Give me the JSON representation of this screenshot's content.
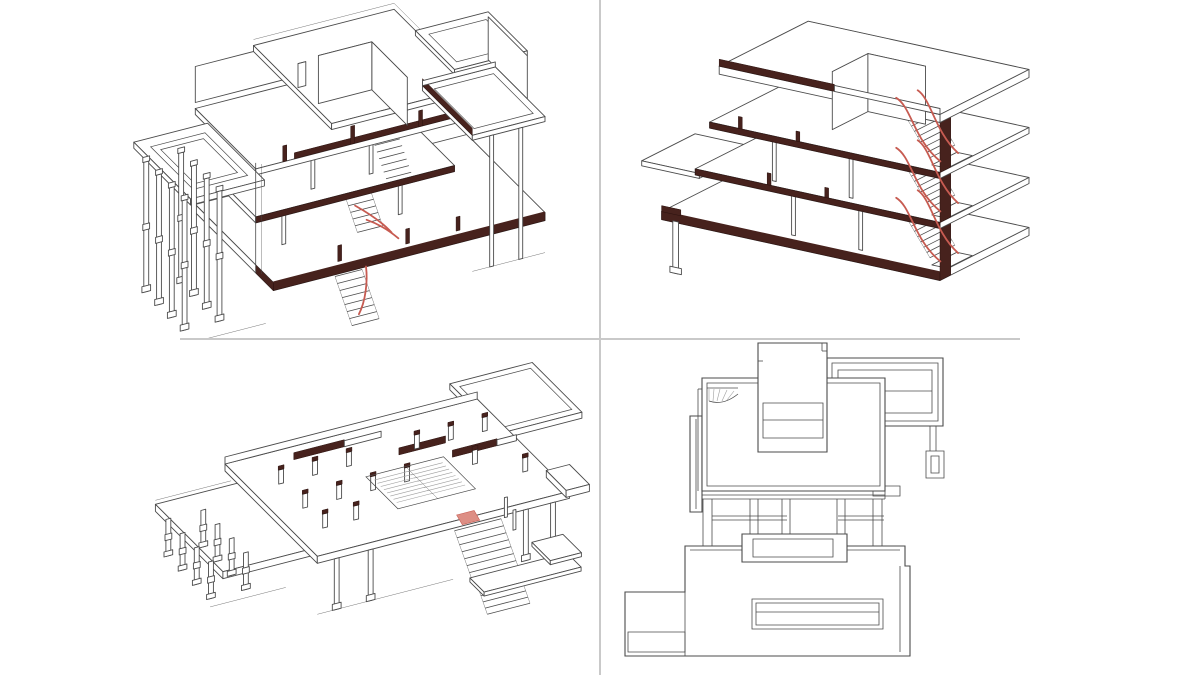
{
  "page": {
    "background": "#ffffff"
  },
  "grid": {
    "rows": 2,
    "cols": 2,
    "divider_color": "#c9c9c9"
  },
  "panels": [
    {
      "id": "tl",
      "name": "sectional-axonometric-southwest",
      "view": "cutaway axonometric with colonnade",
      "accents": [
        "section-walls",
        "stair-rail"
      ]
    },
    {
      "id": "tr",
      "name": "sectional-axonometric-northeast",
      "view": "cutaway axonometric with stacked stairs",
      "accents": [
        "section-walls",
        "stair-rail"
      ]
    },
    {
      "id": "bl",
      "name": "floor-plate-axonometric",
      "view": "single-level axonometric with columns",
      "accents": [
        "section-walls",
        "stair-ramp"
      ]
    },
    {
      "id": "br",
      "name": "roof-plan",
      "view": "orthographic plan",
      "accents": []
    }
  ],
  "colors": {
    "background": "#ffffff",
    "line": "#4b4b4b",
    "line_light": "#a9a9a9",
    "divider": "#c9c9c9",
    "section": "#47221d",
    "section_edge": "#2b120f",
    "accent_red": "#c75b51",
    "accent_red_light": "#dd8e84",
    "hatch": "#9f9f9f"
  }
}
